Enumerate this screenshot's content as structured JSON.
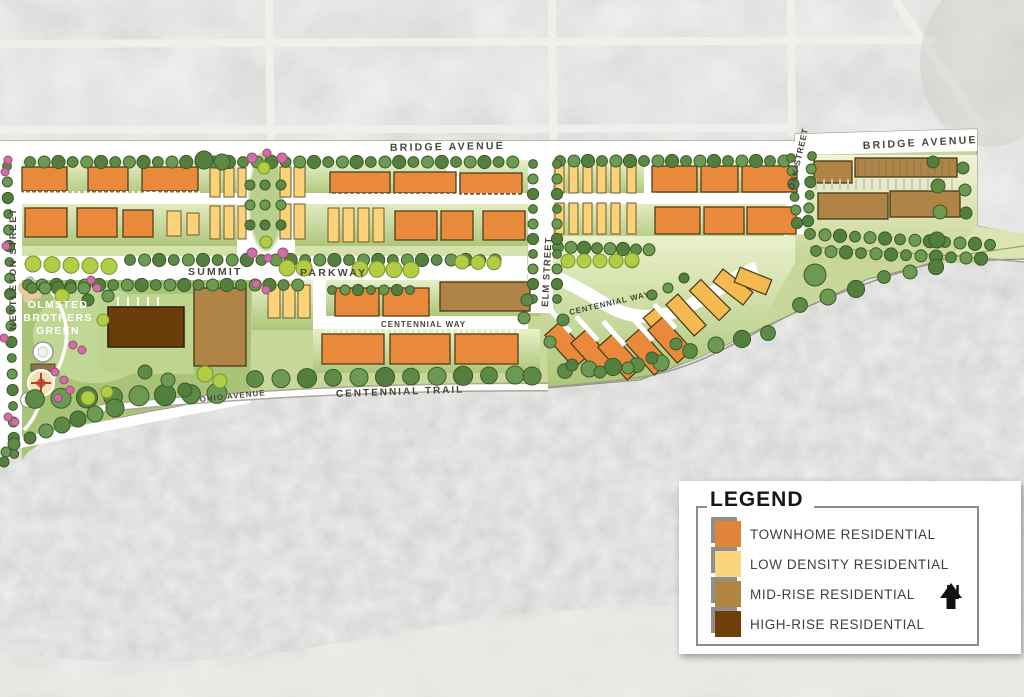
{
  "map": {
    "streets": {
      "bridge_avenue_w": "BRIDGE AVENUE",
      "bridge_avenue_e": "BRIDGE AVENUE",
      "summit": "SUMMIT",
      "parkway": "PARKWAY",
      "nettleton": "NETTLETON STREET",
      "elm": "ELM STREET",
      "oak": "OAK STREET",
      "centennial_way_w": "CENTENNIAL WAY",
      "centennial_way_e": "CENTENNIAL WAY",
      "centennial_trail": "CENTENNIAL TRAIL",
      "ohio": "OHIO AVENUE"
    },
    "park": {
      "line1": "OLMSTED",
      "line2": "BROTHERS",
      "line3": "GREEN"
    }
  },
  "legend": {
    "title": "LEGEND",
    "north": "N",
    "items": [
      {
        "label": "TOWNHOME RESIDENTIAL",
        "color": "#E0843A"
      },
      {
        "label": "LOW DENSITY RESIDENTIAL",
        "color": "#FBD47D"
      },
      {
        "label": "MID-RISE RESIDENTIAL",
        "color": "#B28442"
      },
      {
        "label": "HIGH-RISE RESIDENTIAL",
        "color": "#6E3E0A"
      }
    ]
  }
}
